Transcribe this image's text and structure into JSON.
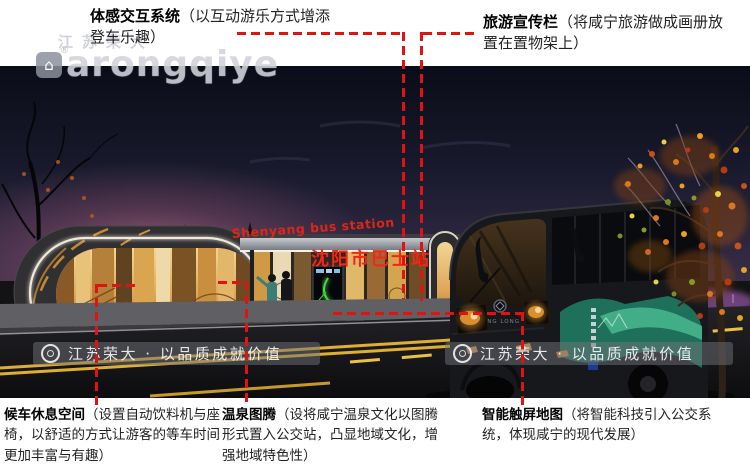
{
  "colors": {
    "callout_line": "#e01212",
    "station_sign_red": "#f03018",
    "glass_amber": "#d9a54f",
    "bus_teal": "#2f9d7d",
    "night_sky": "#10121f",
    "watermark_bar_bg": "rgba(112,114,120,0.5)"
  },
  "annotations": {
    "top_left": {
      "title": "体感交互系统",
      "desc": "（以互动游乐方式增添登车乐趣）"
    },
    "top_right": {
      "title": "旅游宣传栏",
      "desc": "（将咸宁旅游做成画册放置在置物架上）"
    },
    "bottom_left": {
      "title": "候车休息空间",
      "desc": "（设置自动饮料机与座椅，以舒适的方式让游客的等车时间更加丰富与有趣）"
    },
    "bottom_middle": {
      "title": "温泉图腾",
      "desc": "（设将咸宁温泉文化以图腾形式置入公交站，凸显地域文化，增强地域特色性）"
    },
    "bottom_right": {
      "title": "智能触屏地图",
      "desc": "（将智能科技引入公交系统，体现咸宁的现代发展）"
    }
  },
  "scene": {
    "station_sign_en": "Shenyang bus station",
    "station_sign_cn": "沈阳市巴士站",
    "bus_brand": "KING LONG"
  },
  "watermarks": {
    "corner_cn": "江苏荣大",
    "corner_latin": "arongqiye",
    "corner_reg": "®",
    "bar_text": "江苏荣大 · 以品质成就价值"
  }
}
